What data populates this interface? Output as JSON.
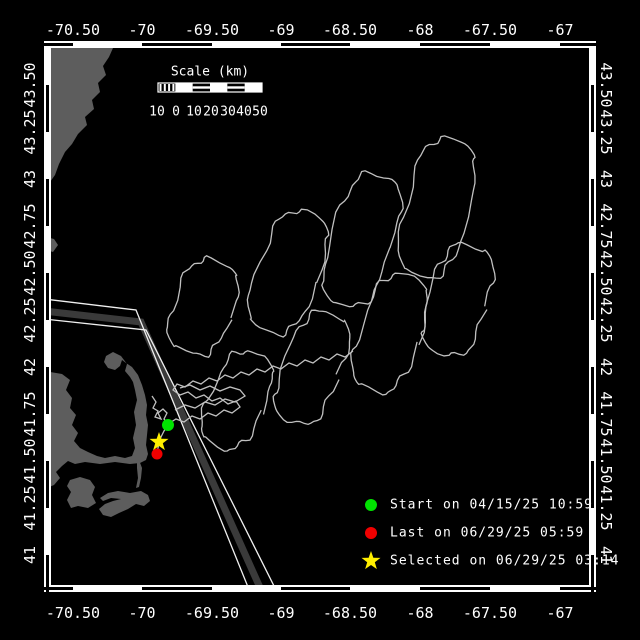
{
  "colors": {
    "background": "#000000",
    "frame": "#ffffff",
    "tick_dash": "#000000",
    "land": "#5d5d5d",
    "track": "#c0c0c0",
    "lane_zone": "#3a3a3a",
    "lane_line": "#f0f0f0",
    "start": "#00e300",
    "last": "#f00000",
    "selected": "#ffee00"
  },
  "axes": {
    "lon": {
      "labels": [
        "-70.50",
        "-70",
        "-69.50",
        "-69",
        "-68.50",
        "-68",
        "-67.50",
        "-67"
      ],
      "x": [
        73,
        142,
        212,
        281,
        350,
        420,
        490,
        560
      ],
      "top_y": 30,
      "bottom_y": 613
    },
    "lat": {
      "labels": [
        "43.50",
        "43.25",
        "43",
        "42.75",
        "42.50",
        "42.25",
        "42",
        "41.75",
        "41.50",
        "41.25",
        "41"
      ],
      "y": [
        85,
        132,
        179,
        226,
        273,
        320,
        367,
        414,
        461,
        508,
        555
      ],
      "left_x": 30,
      "right_x": 606
    }
  },
  "frame": {
    "x1": 44,
    "y1": 41,
    "x2": 596,
    "y2": 592,
    "band": 7,
    "dash": 3
  },
  "scalebar": {
    "title": "Scale (km)",
    "title_x": 210,
    "title_y": 72,
    "bar": {
      "x": 158,
      "y": 83,
      "w": 104,
      "h": 9,
      "segments": 6
    },
    "numbers": [
      "10",
      "0",
      "10",
      "20",
      "30",
      "40",
      "50"
    ],
    "numbers_x": [
      157,
      176,
      194,
      211,
      228,
      244,
      260
    ],
    "numbers_y": 112
  },
  "legend": {
    "marker_x": 371,
    "text_x": 390,
    "row_y": [
      505,
      533,
      561
    ],
    "items": [
      {
        "shape": "circle",
        "color": "#00e300",
        "label": "Start on 04/15/25 10:59"
      },
      {
        "shape": "circle",
        "color": "#f00000",
        "label": "Last on 06/29/25 05:59"
      },
      {
        "shape": "star",
        "color": "#ffee00",
        "label": "Selected on 06/29/25 03:14"
      }
    ]
  },
  "markers": {
    "start": {
      "x": 168,
      "y": 425,
      "r": 6,
      "color": "#00e300"
    },
    "last": {
      "x": 157,
      "y": 454,
      "r": 5.5,
      "color": "#f00000"
    },
    "selected": {
      "x": 159,
      "y": 442,
      "R": 10,
      "r": 4,
      "color": "#ffee00"
    }
  },
  "map": {
    "land": [
      [
        [
          44,
          41
        ],
        [
          113,
          41
        ],
        [
          113,
          48
        ],
        [
          109,
          57
        ],
        [
          103,
          66
        ],
        [
          106,
          75
        ],
        [
          98,
          83
        ],
        [
          100,
          92
        ],
        [
          92,
          100
        ],
        [
          94,
          109
        ],
        [
          85,
          117
        ],
        [
          87,
          125
        ],
        [
          78,
          134
        ],
        [
          72,
          144
        ],
        [
          65,
          152
        ],
        [
          59,
          164
        ],
        [
          55,
          175
        ],
        [
          50,
          182
        ],
        [
          44,
          186
        ]
      ],
      [
        [
          46,
          237
        ],
        [
          54,
          239
        ],
        [
          58,
          245
        ],
        [
          53,
          252
        ],
        [
          46,
          250
        ]
      ],
      [
        [
          44,
          371
        ],
        [
          62,
          374
        ],
        [
          70,
          380
        ],
        [
          66,
          390
        ],
        [
          72,
          398
        ],
        [
          70,
          408
        ],
        [
          76,
          415
        ],
        [
          72,
          425
        ],
        [
          78,
          433
        ],
        [
          74,
          441
        ],
        [
          80,
          448
        ],
        [
          88,
          452
        ],
        [
          97,
          456
        ],
        [
          105,
          458
        ],
        [
          115,
          456
        ],
        [
          125,
          458
        ],
        [
          132,
          456
        ],
        [
          135,
          448
        ],
        [
          133,
          438
        ],
        [
          136,
          425
        ],
        [
          134,
          412
        ],
        [
          137,
          400
        ],
        [
          135,
          390
        ],
        [
          133,
          382
        ],
        [
          130,
          377
        ],
        [
          125,
          371
        ],
        [
          127,
          364
        ],
        [
          121,
          356
        ],
        [
          113,
          352
        ],
        [
          106,
          356
        ],
        [
          104,
          362
        ],
        [
          108,
          368
        ],
        [
          115,
          370
        ],
        [
          120,
          366
        ],
        [
          122,
          360
        ],
        [
          126,
          363
        ],
        [
          132,
          367
        ],
        [
          138,
          375
        ],
        [
          142,
          385
        ],
        [
          145,
          395
        ],
        [
          147,
          405
        ],
        [
          146,
          415
        ],
        [
          148,
          425
        ],
        [
          147,
          435
        ],
        [
          146,
          445
        ],
        [
          148,
          454
        ],
        [
          146,
          460
        ],
        [
          140,
          463
        ],
        [
          130,
          464
        ],
        [
          115,
          462
        ],
        [
          100,
          464
        ],
        [
          85,
          462
        ],
        [
          75,
          464
        ],
        [
          68,
          461
        ],
        [
          62,
          466
        ],
        [
          56,
          472
        ],
        [
          60,
          478
        ],
        [
          54,
          485
        ],
        [
          44,
          489
        ]
      ],
      [
        [
          139,
          460
        ],
        [
          142,
          468
        ],
        [
          141,
          478
        ],
        [
          139,
          487
        ],
        [
          136,
          488
        ],
        [
          138,
          478
        ],
        [
          137,
          468
        ],
        [
          137,
          461
        ]
      ],
      [
        [
          70,
          480
        ],
        [
          80,
          477
        ],
        [
          90,
          480
        ],
        [
          95,
          487
        ],
        [
          92,
          495
        ],
        [
          96,
          503
        ],
        [
          88,
          508
        ],
        [
          78,
          506
        ],
        [
          71,
          508
        ],
        [
          67,
          500
        ],
        [
          71,
          492
        ],
        [
          67,
          486
        ]
      ],
      [
        [
          100,
          498
        ],
        [
          108,
          493
        ],
        [
          118,
          491
        ],
        [
          130,
          493
        ],
        [
          141,
          491
        ],
        [
          148,
          495
        ],
        [
          150,
          501
        ],
        [
          144,
          506
        ],
        [
          136,
          504
        ],
        [
          128,
          509
        ],
        [
          119,
          513
        ],
        [
          111,
          517
        ],
        [
          103,
          515
        ],
        [
          99,
          509
        ],
        [
          105,
          504
        ],
        [
          113,
          501
        ],
        [
          121,
          499
        ],
        [
          111,
          498
        ],
        [
          103,
          501
        ]
      ]
    ],
    "lane": {
      "west_line": [
        [
          44,
          299
        ],
        [
          136,
          310
        ],
        [
          250,
          592
        ]
      ],
      "zone": [
        [
          44,
          311
        ],
        [
          141,
          322
        ],
        [
          262,
          592
        ]
      ],
      "east_line": [
        [
          44,
          319
        ],
        [
          146,
          330
        ],
        [
          277,
          592
        ]
      ]
    },
    "track": {
      "segments": [
        [
          [
            152,
            396
          ],
          [
            156,
            402
          ],
          [
            153,
            408
          ],
          [
            158,
            411
          ],
          [
            155,
            417
          ],
          [
            161,
            419
          ],
          [
            158,
            413
          ],
          [
            163,
            409
          ],
          [
            167,
            413
          ],
          [
            164,
            419
          ],
          [
            168,
            424
          ]
        ],
        [
          [
            168,
            425
          ],
          [
            164,
            431
          ],
          [
            161,
            437
          ],
          [
            159,
            442
          ],
          [
            158,
            448
          ],
          [
            157,
            452
          ]
        ],
        [
          [
            168,
            424
          ],
          [
            176,
            419
          ],
          [
            184,
            422
          ],
          [
            192,
            416
          ],
          [
            200,
            419
          ],
          [
            208,
            413
          ],
          [
            216,
            416
          ],
          [
            224,
            410
          ],
          [
            232,
            413
          ],
          [
            240,
            407
          ],
          [
            236,
            401
          ],
          [
            228,
            404
          ],
          [
            220,
            398
          ],
          [
            212,
            401
          ],
          [
            204,
            395
          ],
          [
            196,
            398
          ],
          [
            188,
            392
          ],
          [
            180,
            395
          ],
          [
            173,
            390
          ],
          [
            177,
            384
          ],
          [
            185,
            387
          ],
          [
            193,
            381
          ],
          [
            201,
            384
          ],
          [
            209,
            378
          ],
          [
            217,
            381
          ],
          [
            225,
            375
          ],
          [
            233,
            378
          ],
          [
            241,
            372
          ],
          [
            249,
            375
          ],
          [
            257,
            369
          ],
          [
            265,
            372
          ],
          [
            273,
            366
          ],
          [
            281,
            369
          ],
          [
            289,
            363
          ],
          [
            297,
            366
          ],
          [
            305,
            360
          ],
          [
            313,
            363
          ],
          [
            321,
            357
          ],
          [
            329,
            360
          ],
          [
            337,
            354
          ],
          [
            345,
            357
          ],
          [
            353,
            351
          ]
        ],
        [
          [
            175,
            410
          ],
          [
            185,
            405
          ],
          [
            195,
            408
          ],
          [
            205,
            402
          ],
          [
            215,
            405
          ],
          [
            225,
            399
          ],
          [
            235,
            402
          ],
          [
            245,
            396
          ],
          [
            240,
            390
          ],
          [
            230,
            387
          ],
          [
            220,
            391
          ],
          [
            210,
            386
          ],
          [
            200,
            390
          ],
          [
            190,
            385
          ],
          [
            180,
            388
          ]
        ]
      ],
      "loops": [
        {
          "cx": 203,
          "cy": 307,
          "w": 58,
          "h": 95,
          "rot": 20
        },
        {
          "cx": 288,
          "cy": 272,
          "w": 60,
          "h": 125,
          "rot": 20
        },
        {
          "cx": 362,
          "cy": 240,
          "w": 60,
          "h": 135,
          "rot": 17
        },
        {
          "cx": 437,
          "cy": 208,
          "w": 62,
          "h": 140,
          "rot": 14
        },
        {
          "cx": 237,
          "cy": 400,
          "w": 54,
          "h": 100,
          "rot": 24
        },
        {
          "cx": 312,
          "cy": 368,
          "w": 56,
          "h": 115,
          "rot": 21
        },
        {
          "cx": 390,
          "cy": 333,
          "w": 58,
          "h": 120,
          "rot": 19
        },
        {
          "cx": 458,
          "cy": 300,
          "w": 58,
          "h": 112,
          "rot": 16
        }
      ]
    }
  }
}
